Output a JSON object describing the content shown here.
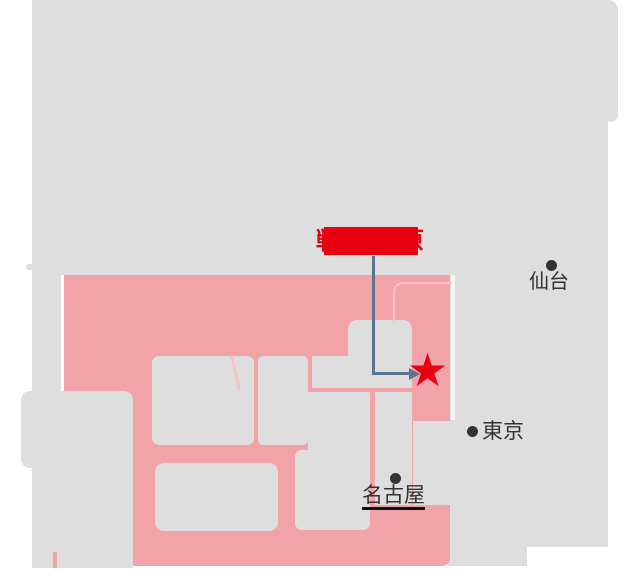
{
  "map": {
    "redacted_label": {
      "text": "戦場ヶ原",
      "redacted": true
    },
    "cities": {
      "sendai": "仙台",
      "tokyo": "東京",
      "nagoya": "名古屋"
    },
    "marker": {
      "star_glyph": "★"
    },
    "colors": {
      "base_grey": "#dedede",
      "highlight_pink": "#f2a3a8",
      "border_light_pink": "#f6c3c8",
      "accent_red": "#e60012",
      "arrow_blue_grey": "#5b7591",
      "city_text": "#333333"
    }
  }
}
